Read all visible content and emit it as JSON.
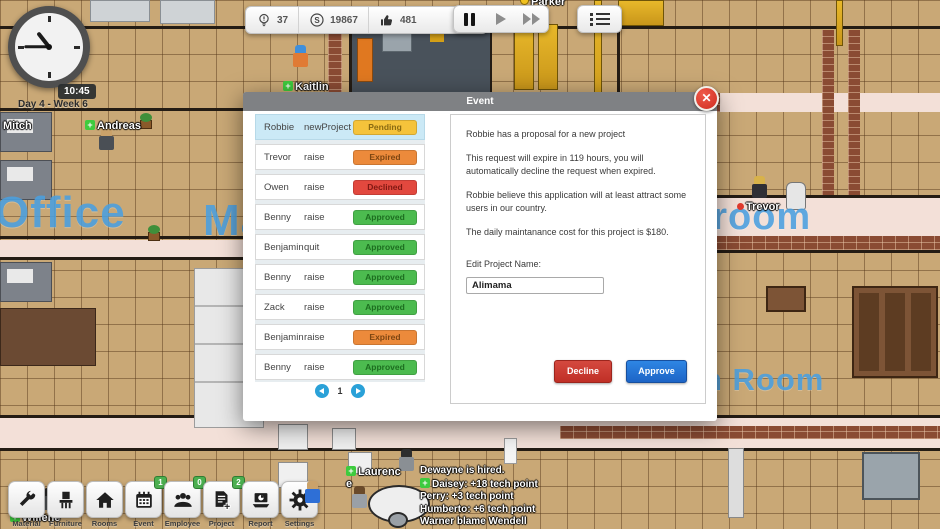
{
  "hud": {
    "clock": {
      "time": "10:45",
      "day_label": "Day 4 - Week 6"
    },
    "resources": {
      "ideas": "37",
      "money": "19867",
      "likes": "481"
    },
    "icons": {
      "ideas": "lightbulb-icon",
      "money": "circled-s-icon",
      "likes": "thumbs-up-icon",
      "pause": "pause-icon",
      "play": "play-icon",
      "fast_forward": "fast-forward-icon",
      "menu": "list-menu-icon"
    },
    "toolbar": [
      {
        "label": "Material",
        "icon": "wrench-icon",
        "badge": ""
      },
      {
        "label": "Furniture",
        "icon": "chair-icon",
        "badge": ""
      },
      {
        "label": "Rooms",
        "icon": "house-icon",
        "badge": ""
      },
      {
        "label": "Event",
        "icon": "calendar-icon",
        "badge": "1"
      },
      {
        "label": "Employee",
        "icon": "people-icon",
        "badge": "0"
      },
      {
        "label": "Project",
        "icon": "document-plus-icon",
        "badge": "2"
      },
      {
        "label": "Report",
        "icon": "laptop-chart-icon",
        "badge": ""
      },
      {
        "label": "Settings",
        "icon": "gear-icon",
        "badge": ""
      }
    ]
  },
  "map": {
    "room_labels": [
      {
        "text": "Office"
      },
      {
        "text": "Ma"
      },
      {
        "text": "hroom"
      },
      {
        "text": "h Room"
      }
    ],
    "characters": [
      {
        "name": "Mitch"
      },
      {
        "name": "Andreas"
      },
      {
        "name": "Kaitlin"
      },
      {
        "name": "Parker"
      },
      {
        "name": "Trevor"
      },
      {
        "name": "Laurence"
      },
      {
        "name": "Willene"
      }
    ],
    "notifications": [
      "Dewayne is hired.",
      "Daisey: +18 tech point",
      "Perry: +3 tech point",
      "Humberto: +6 tech point",
      "Warner blame Wendell"
    ]
  },
  "modal": {
    "title": "Event",
    "close_icon": "✕",
    "requests": [
      {
        "name": "Robbie",
        "type": "newProject",
        "status": "Pending"
      },
      {
        "name": "Trevor",
        "type": "raise",
        "status": "Expired"
      },
      {
        "name": "Owen",
        "type": "raise",
        "status": "Declined"
      },
      {
        "name": "Benny",
        "type": "raise",
        "status": "Approved"
      },
      {
        "name": "Benjamin",
        "type": "quit",
        "status": "Approved"
      },
      {
        "name": "Benny",
        "type": "raise",
        "status": "Approved"
      },
      {
        "name": "Zack",
        "type": "raise",
        "status": "Approved"
      },
      {
        "name": "Benjamin",
        "type": "raise",
        "status": "Expired"
      },
      {
        "name": "Benny",
        "type": "raise",
        "status": "Approved"
      }
    ],
    "pagination": {
      "page": "1"
    },
    "detail": {
      "paragraphs": [
        "Robbie has a proposal for a new project",
        "This request will expire in 119 hours, you will automatically decline the request when expired.",
        "Robbie believe this application will at least attract some users in our country.",
        "The daily maintanance cost for this project is $180."
      ],
      "edit_label": "Edit Project Name:",
      "project_name": "Alimama",
      "decline_label": "Decline",
      "approve_label": "Approve"
    }
  },
  "colors": {
    "approve_blue": "#2379DB",
    "decline_red": "#C9362C",
    "pending_yellow": "#F5C33B",
    "expired_orange": "#EC8A3B",
    "declined_red": "#E2483E",
    "approved_green": "#4CBB4F",
    "selected_row_blue": "#CBE9F6",
    "pagination_blue": "#2AA1D8",
    "badge_green": "#4CAF50",
    "room_label_blue": "#4AA0E0"
  }
}
